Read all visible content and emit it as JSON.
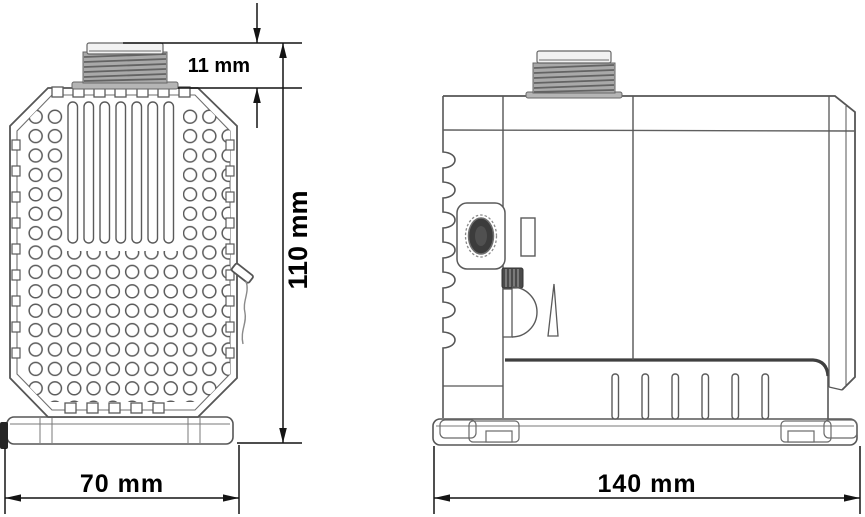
{
  "drawing": {
    "kind": "technical-dimension-drawing",
    "subject": "submersible pump, front and side orthographic views",
    "views": {
      "front": {
        "name": "front view with perforated intake grille"
      },
      "side": {
        "name": "side view with threaded outlet and mounting base"
      }
    },
    "dimensions": {
      "outlet_height": "11 mm",
      "overall_height": "110 mm",
      "front_width": "70 mm",
      "side_width": "140 mm"
    },
    "colors": {
      "background": "#ffffff",
      "line": "#5a5a5a",
      "dim_line": "#141414",
      "text": "#000000",
      "thread_fill": "#a9a9a9",
      "dark_detail": "#3c3c3c"
    }
  }
}
